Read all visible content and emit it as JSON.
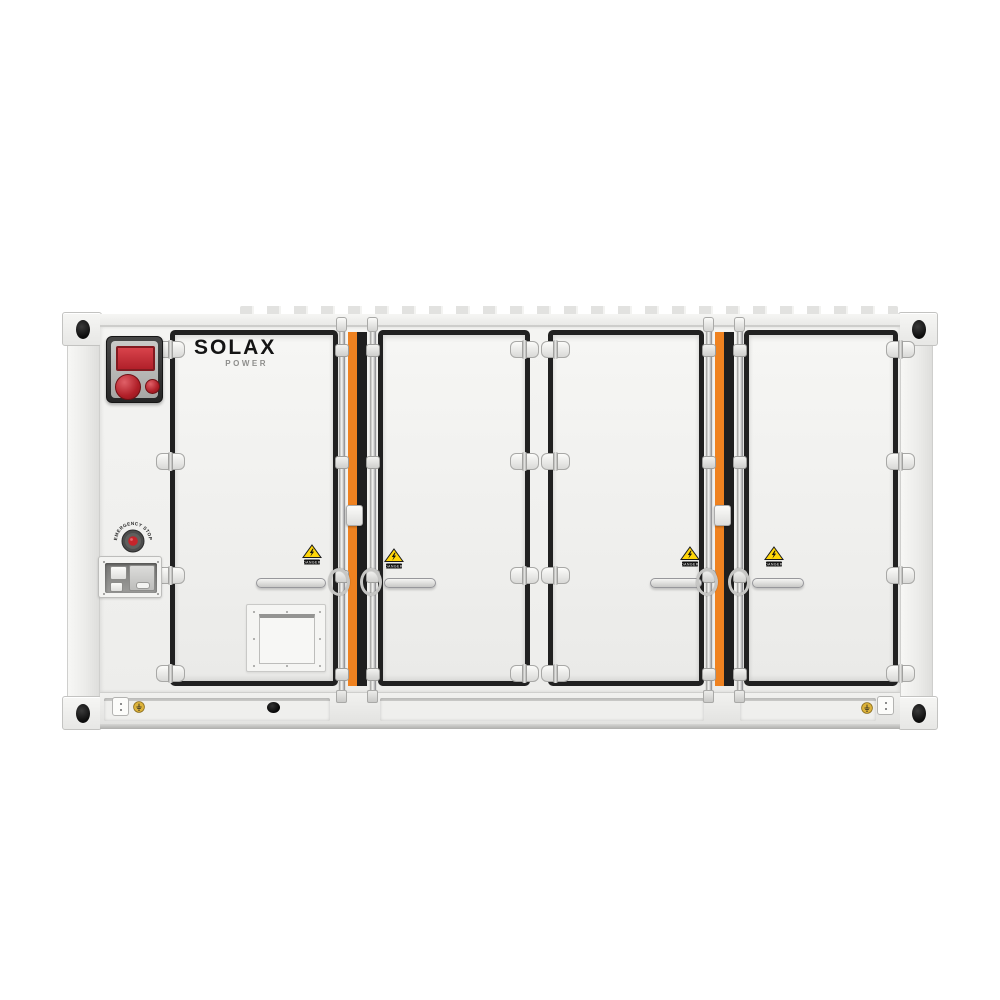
{
  "product": {
    "brand": "SOLAX",
    "brand_sub": "POWER"
  },
  "labels": {
    "emergency_stop": "EMERGENCY STOP",
    "danger": "DANGER"
  },
  "structure": {
    "door_count": 4,
    "danger_sticker_count": 4,
    "hinge_rows": 4,
    "lock_rod_count": 4
  },
  "colors": {
    "background": "#ffffff",
    "body_white": "#f2f2f0",
    "door_gasket_black": "#212121",
    "accent_orange": "#ef8220",
    "warning_yellow": "#ffd608",
    "alarm_red": "#c2262e",
    "ground_sticker_yellow": "#ddb33a"
  },
  "icons": {
    "danger_sticker": "high-voltage-warning-triangle",
    "ground_sticker": "earth-ground-symbol",
    "emergency_stop": "red-push-button",
    "corner_casting": "container-corner-hole"
  }
}
